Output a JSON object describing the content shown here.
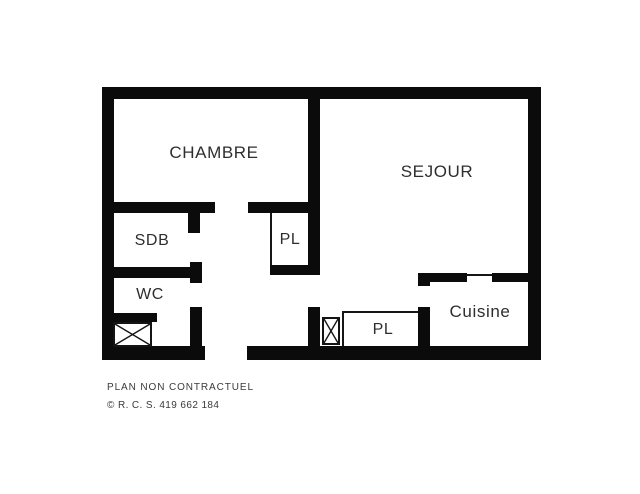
{
  "plan": {
    "title": "apartment-floor-plan",
    "rooms": {
      "chambre": {
        "label": "CHAMBRE"
      },
      "sejour": {
        "label": "SEJOUR"
      },
      "sdb": {
        "label": "SDB"
      },
      "wc": {
        "label": "WC"
      },
      "placard_couloir": {
        "label": "PL"
      },
      "placard_entree": {
        "label": "PL"
      },
      "cuisine": {
        "label": "Cuisine"
      }
    },
    "symbols": {
      "shaft_wc": "crossed-box-shaft",
      "shaft_entree": "crossed-box-shaft"
    },
    "colors": {
      "wall": "#0b0b0b",
      "background": "#ffffff",
      "label_text": "#2e2e2e",
      "footer_text": "#3a3a3a"
    }
  },
  "footer": {
    "disclaimer": "PLAN NON CONTRACTUEL",
    "registration": "© R. C. S. 419 662 184"
  }
}
